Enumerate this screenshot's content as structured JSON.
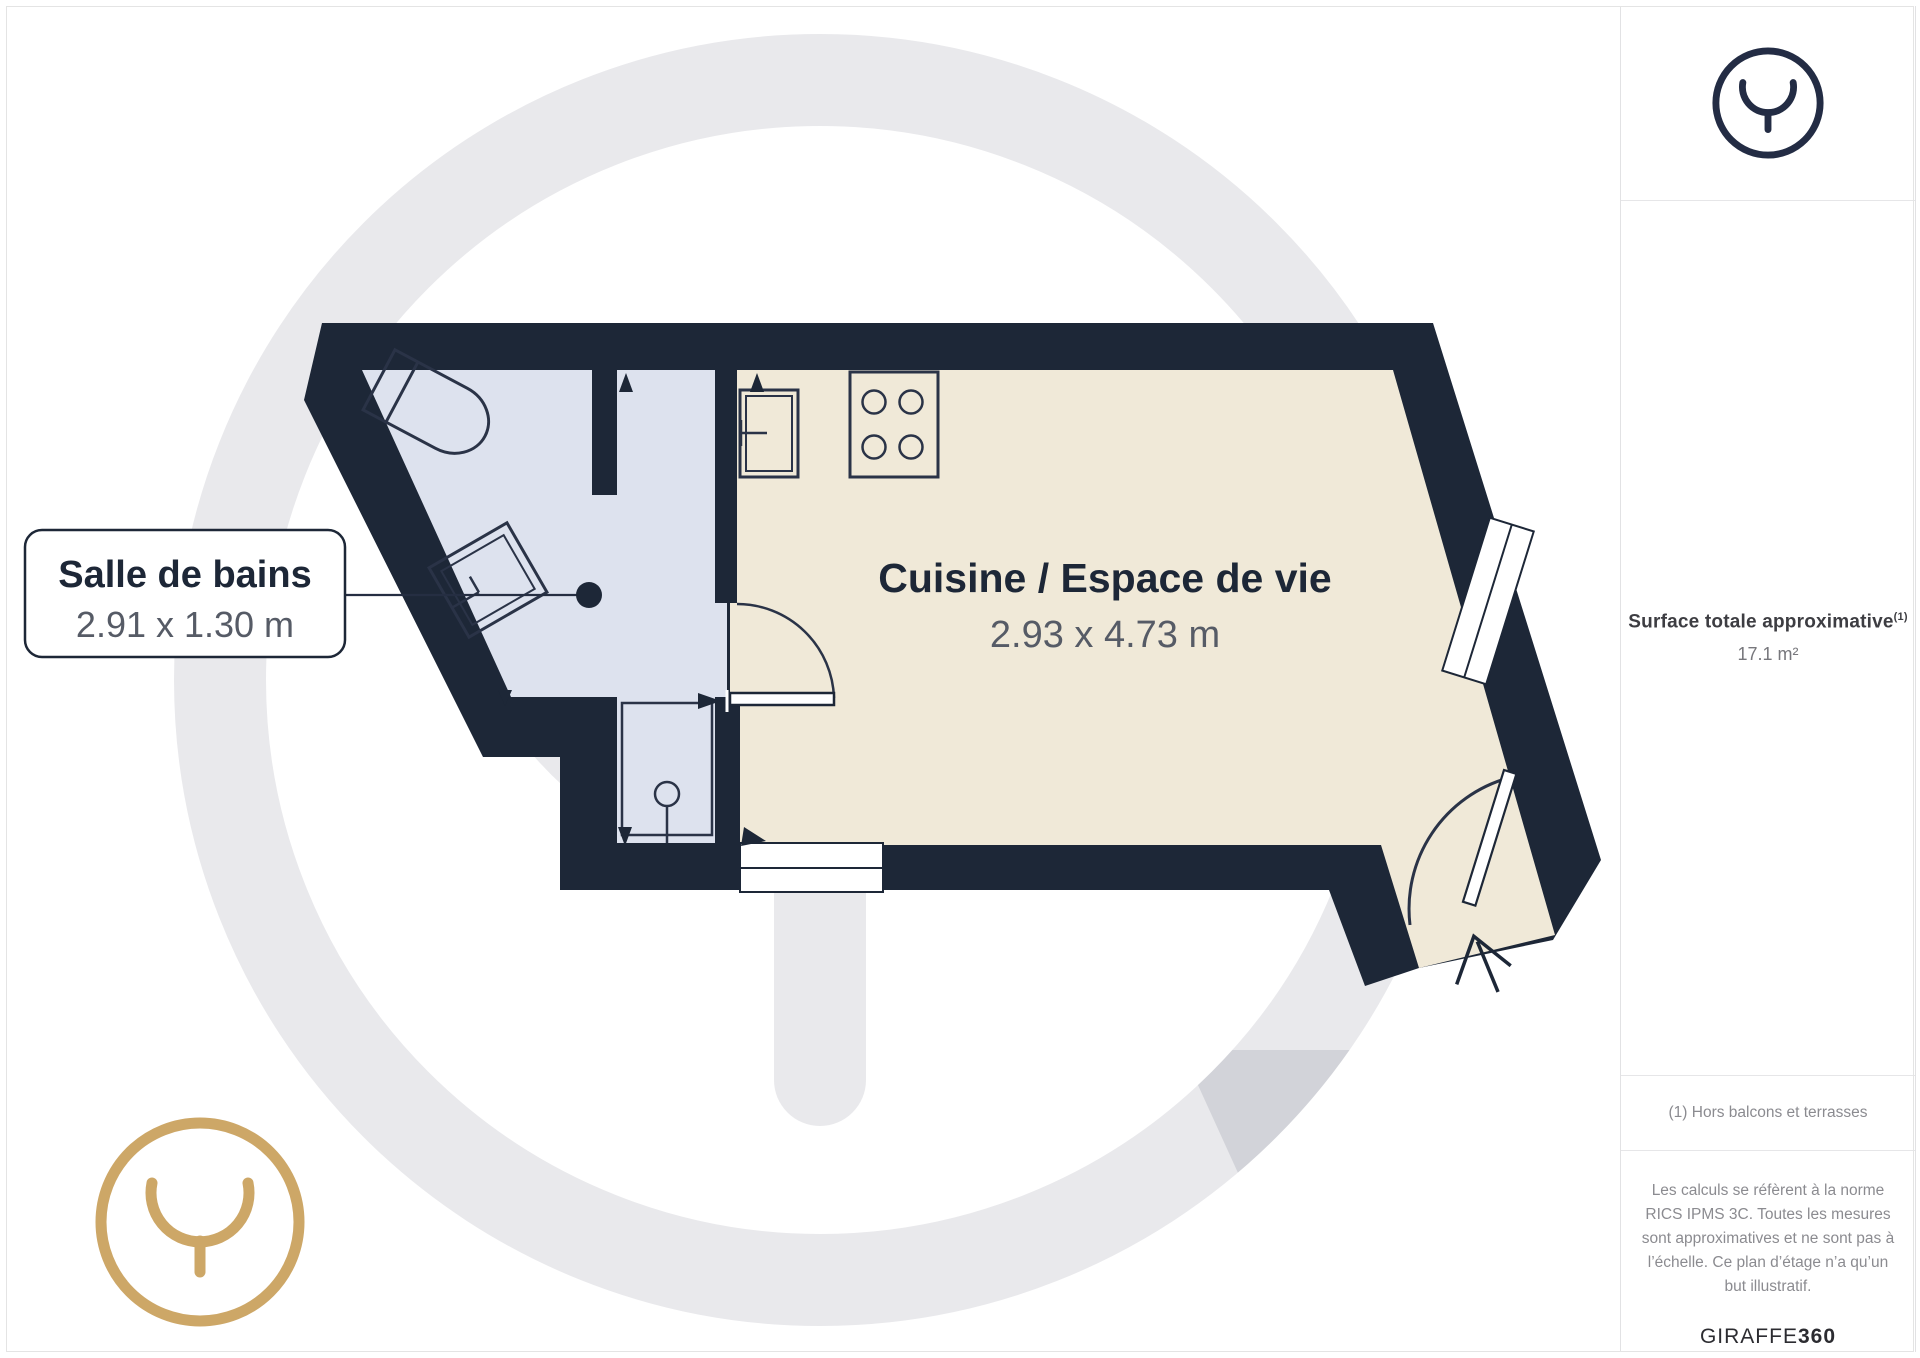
{
  "page": {
    "background": "#ffffff",
    "border_color": "#e4e4e4"
  },
  "floorplan": {
    "labels": {
      "bathroom": {
        "name": "Salle de bains",
        "dimensions": "2.91 x 1.30 m"
      },
      "living": {
        "name": "Cuisine / Espace de vie",
        "dimensions": "2.93 x 4.73 m"
      }
    },
    "colors": {
      "wall": "#1d2737",
      "bathroom_floor": "#dde2ee",
      "living_floor": "#f0e9d8",
      "watermark_gray": "#e9e9ec",
      "logo_gold": "#cda767",
      "logo_navy": "#232c44"
    }
  },
  "sidebar": {
    "surface_label": "Surface totale approximative",
    "surface_note_ref": "(1)",
    "surface_value": "17.1 m²",
    "footnote": "(1) Hors balcons et terrasses",
    "disclaimer": "Les calculs se réfèrent à la norme RICS IPMS 3C. Toutes les mesures sont approximatives et ne sont pas à l’échelle. Ce plan d’étage n’a qu’un but illustratif.",
    "brand_name": "GIRAFFE",
    "brand_suffix": "360"
  }
}
